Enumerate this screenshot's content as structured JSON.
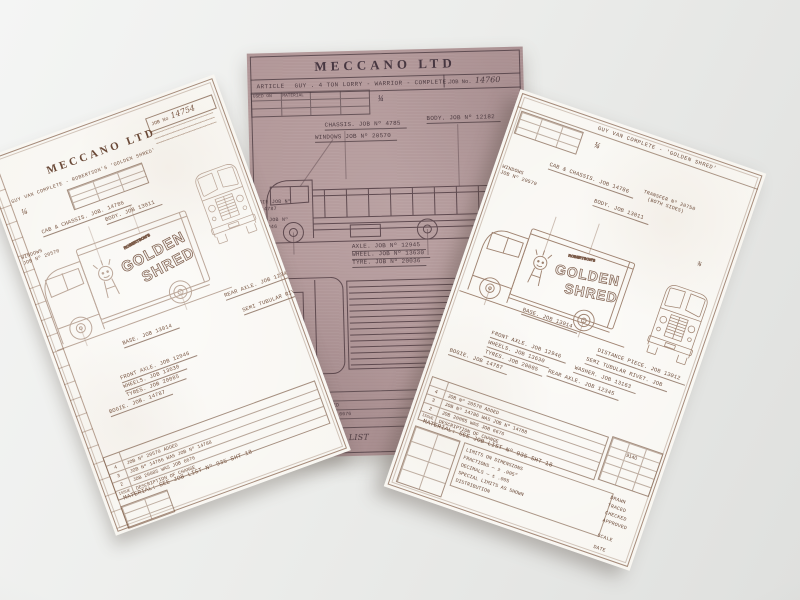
{
  "colors": {
    "diazo_paper": "#b09596",
    "white_paper": "#f8f6f1",
    "ink_dark": "#4e3c42",
    "ink_faded": "#8a6751"
  },
  "middle": {
    "brand": "MECCANO LTD",
    "article_label": "ARTICLE",
    "article": "GUY . 4 TON LORRY - WARRIOR - COMPLETE.",
    "job_label": "JOB No.",
    "job_no": "14760",
    "used_on_label": "USED ON",
    "material_col_label": "MATERIAL",
    "scale": "¼",
    "labels": {
      "chassis": "CHASSIS. JOB Nº 4785",
      "body": "BODY. JOB Nº 12182",
      "windows": "WINDOWS JOB Nº 20570",
      "bogie_l1": "BOGIE JOB Nº",
      "bogie_l2": "14787",
      "axle_front_l1": "AXLE JOB Nº",
      "axle_front_l2": "12946",
      "axle": "AXLE. JOB Nº 12945",
      "wheel": "WHEEL. JOB Nº 13630",
      "tyre": "TYRE. JOB Nº 20036"
    },
    "revisions": [
      {
        "issue": "3",
        "change": "JOB Nº 20370 ADDED"
      },
      {
        "issue": "2",
        "change": "JOB 20095 WAS JOB 6676"
      }
    ],
    "issue_label": "ISSUE",
    "material_note": "MATERIAL:",
    "material_value": "JOB LIST"
  },
  "left": {
    "brand": "MECCANO LTD",
    "article": "GUY VAN COMPLETE - ROBERTSON'S 'GOLDEN SHRED'",
    "job_label": "JOB No",
    "job_no": "14754",
    "scale": "¼",
    "livery": {
      "maker": "ROBERTSON'S",
      "line1": "GOLDEN",
      "line2": "SHRED"
    },
    "labels": {
      "cab_chassis": "CAB & CHASSIS. JOB. 14786",
      "body": "BODY. JOB 13011",
      "windows_l1": "WINDOWS",
      "windows_l2": "JOB Nº 20570",
      "base": "BASE. JOB 13014",
      "rear_axle": "REAR AXLE. JOB 12345",
      "semi_rivet": "SEMI TUBULAR RIVET. JOB",
      "front_axle": "FRONT AXLE. JOB 12946",
      "wheels": "WHEELS. JOB 13630",
      "tyres": "TYRES. JOB 20085",
      "bogie": "BOGIE. JOB. 14787"
    },
    "revisions": [
      {
        "issue": "4",
        "change": "JOB Nº 20570 ADDED"
      },
      {
        "issue": "3",
        "change": "JOB Nº 14786 WAS JOB Nº 14788"
      },
      {
        "issue": "2",
        "change": "JOB 20085 WAS JOB 6676"
      }
    ],
    "issue_label": "ISSUE",
    "change_label": "DESCRIPTION OF CHANGE",
    "material_note": "MATERIAL: SEE JOB LIST Nº 935 SHT 18"
  },
  "right": {
    "article": "GUY VAN COMPLETE - 'GOLDEN SHRED'",
    "scale": "¼",
    "dim_fraction": "¾",
    "livery": {
      "maker": "ROBERTSON'S",
      "line1": "GOLDEN",
      "line2": "SHRED"
    },
    "labels": {
      "cab_chassis": "CAB & CHASSIS. JOB 14786",
      "windows_l1": "WINDOWS",
      "windows_l2": "JOB Nº 20570",
      "body": "BODY. JOB 13011",
      "transfer_l1": "TRANSFER Nº 20750",
      "transfer_l2": "(BOTH SIDES)",
      "base": "BASE. JOB 13014",
      "distance": "DISTANCE PIECE. JOB 13012",
      "semi_rivet": "SEMI TUBULAR RIVET. JOB",
      "washer": "WASHER. JOB 13163",
      "rear_axle": "REAR AXLE. JOB 12345",
      "front_axle": "FRONT AXLE. JOB 12946",
      "wheels": "WHEELS. JOB 13630",
      "tyres": "TYRES. JOB 20085",
      "bogie": "BOGIE. JOB 14787"
    },
    "revisions": [
      {
        "issue": "4",
        "change": "JOB Nº 20570 ADDED"
      },
      {
        "issue": "3",
        "change": "JOB Nº 14786 WAS JOB Nº 14788"
      },
      {
        "issue": "2",
        "change": "JOB 20085 WAS JOB 6676"
      }
    ],
    "issue_label": "ISSUE",
    "change_label": "DESCRIPTION OF CHANGE",
    "material_note": "MATERIAL: SEE JOB LIST Nº 935 SHT 18",
    "grid_no": "9140",
    "limits": {
      "title": "LIMITS ON DIMENSIONS",
      "fractions": "FRACTIONS — ± .005″",
      "decimals": "DECIMALS — ± .005",
      "special": "SPECIAL LIMITS AS SHOWN",
      "distribution": "DISTRIBUTION",
      "col": [
        "DRAWN",
        "TRACED",
        "CHECKED",
        "APPROVED",
        "SCALE",
        "DATE"
      ]
    }
  }
}
